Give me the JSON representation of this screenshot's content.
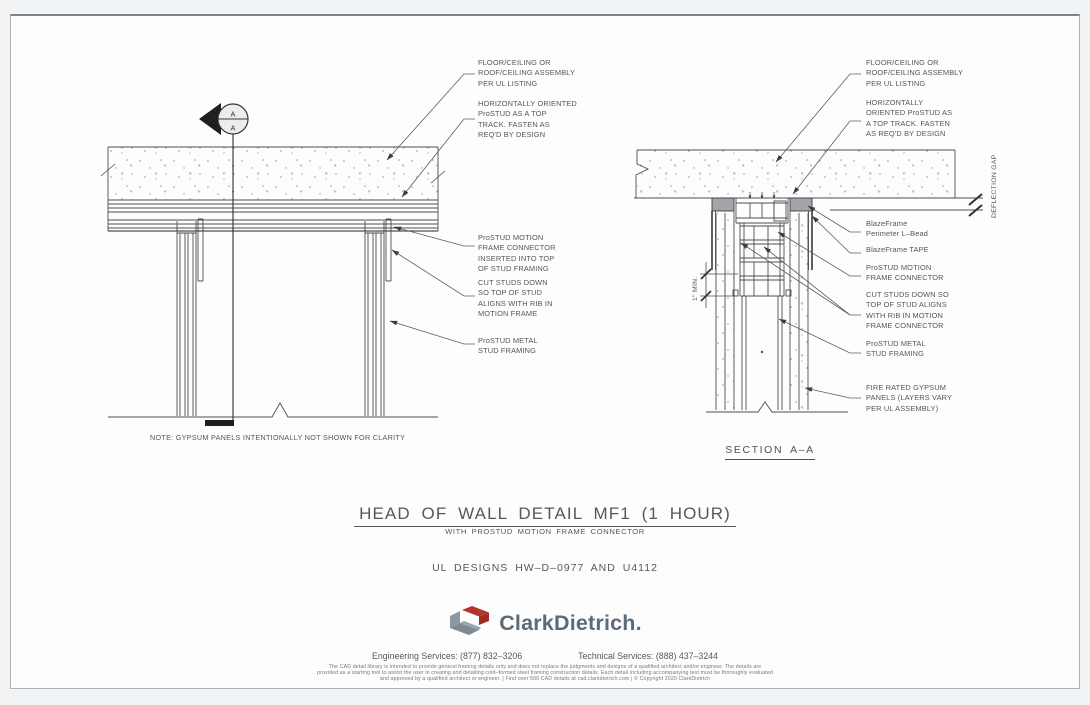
{
  "colors": {
    "line": "#4b4e51",
    "text": "#53565a",
    "logo_red": "#b5352b",
    "logo_gray": "#8c98a3",
    "brand_text": "#5d6b76",
    "sheet_bg": "#fdfdfe",
    "page_bg": "#f2f3f4"
  },
  "left_detail": {
    "section_marker_top": "A",
    "section_marker_bottom": "A",
    "callouts": [
      {
        "text": "FLOOR/CEILING OR\nROOF/CEILING ASSEMBLY\nPER UL LISTING"
      },
      {
        "text": "HORIZONTALLY ORIENTED\nProSTUD AS A TOP\nTRACK. FASTEN AS\nREQ'D BY DESIGN"
      },
      {
        "text": "ProSTUD MOTION\nFRAME CONNECTOR\nINSERTED INTO TOP\nOF STUD FRAMING"
      },
      {
        "text": "CUT STUDS DOWN\nSO TOP OF STUD\nALIGNS WITH RIB IN\nMOTION FRAME"
      },
      {
        "text": "ProSTUD METAL\nSTUD FRAMING"
      }
    ],
    "note": "NOTE: GYPSUM PANELS INTENTIONALLY NOT SHOWN FOR CLARITY"
  },
  "right_detail": {
    "callouts": [
      {
        "text": "FLOOR/CEILING OR\nROOF/CEILING ASSEMBLY\nPER UL LISTING"
      },
      {
        "text": "HORIZONTALLY\nORIENTED ProSTUD AS\nA TOP TRACK. FASTEN\nAS REQ'D BY DESIGN"
      },
      {
        "text": "BlazeFrame\nPerimeter L–Bead"
      },
      {
        "text": "BlazeFrame TAPE"
      },
      {
        "text": "ProSTUD MOTION\nFRAME CONNECTOR"
      },
      {
        "text": "CUT STUDS DOWN SO\nTOP OF STUD ALIGNS\nWITH RIB IN MOTION\nFRAME CONNECTOR"
      },
      {
        "text": "ProSTUD METAL\nSTUD FRAMING"
      },
      {
        "text": "FIRE RATED GYPSUM\nPANELS (LAYERS VARY\nPER UL ASSEMBLY)"
      }
    ],
    "deflection_label": "DEFLECTION GAP",
    "dimension_label": "1\" MIN.",
    "section_title": "SECTION A–A"
  },
  "title_block": {
    "title": "HEAD OF WALL DETAIL MF1 (1 HOUR)",
    "subtitle": "WITH PROSTUD MOTION FRAME CONNECTOR",
    "ul_designs": "UL DESIGNS HW–D–0977 AND U4112"
  },
  "footer": {
    "brand": "ClarkDietrich.",
    "engineering_services": "Engineering Services: (877) 832–3206",
    "technical_services": "Technical Services: (888) 437–3244",
    "disclaimer": "The CAD detail library is intended to provide general framing details only and does not replace the judgments and designs of a qualified architect and/or engineer. The details are\nprovided as a starting tool to assist the user in creating and detailing cold–formed steel framing construction details. Each detail including accompanying text must be thoroughly evaluated\nand approved by a qualified architect or engineer.    |    Find over 500 CAD details at cad.clarkdietrich.com    |    © Copyright 2020 ClarkDietrich"
  }
}
